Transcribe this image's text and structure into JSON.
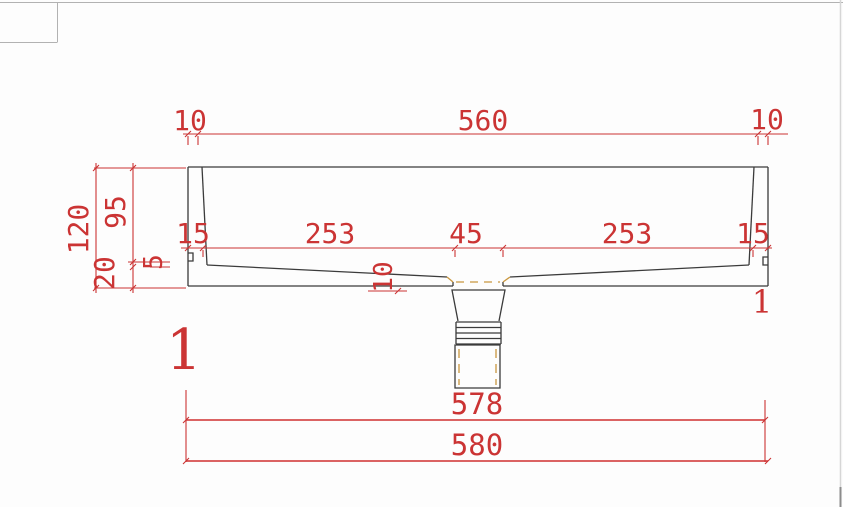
{
  "drawing": {
    "title": "sink-cross-section",
    "dimensions": {
      "top": {
        "left_rim": "10",
        "span": "560",
        "right_rim": "10"
      },
      "left": {
        "total_height": "120",
        "bowl_depth": "95",
        "base_thickness": "20",
        "step": "5"
      },
      "middle": {
        "left_wall": "15",
        "left_bottom": "253",
        "drain_width": "45",
        "right_bottom": "253",
        "right_wall": "15"
      },
      "drain_drop": "10",
      "bottom": {
        "inner_width": "578",
        "outer_width": "580"
      },
      "left_mark": "1",
      "right_mark": "1"
    },
    "colors": {
      "dimension_red": "#cb3434",
      "outline_dark": "#3b3b3b",
      "hidden_orange": "#c9973f",
      "canvas_border_gray": "#b2b2b2"
    }
  }
}
